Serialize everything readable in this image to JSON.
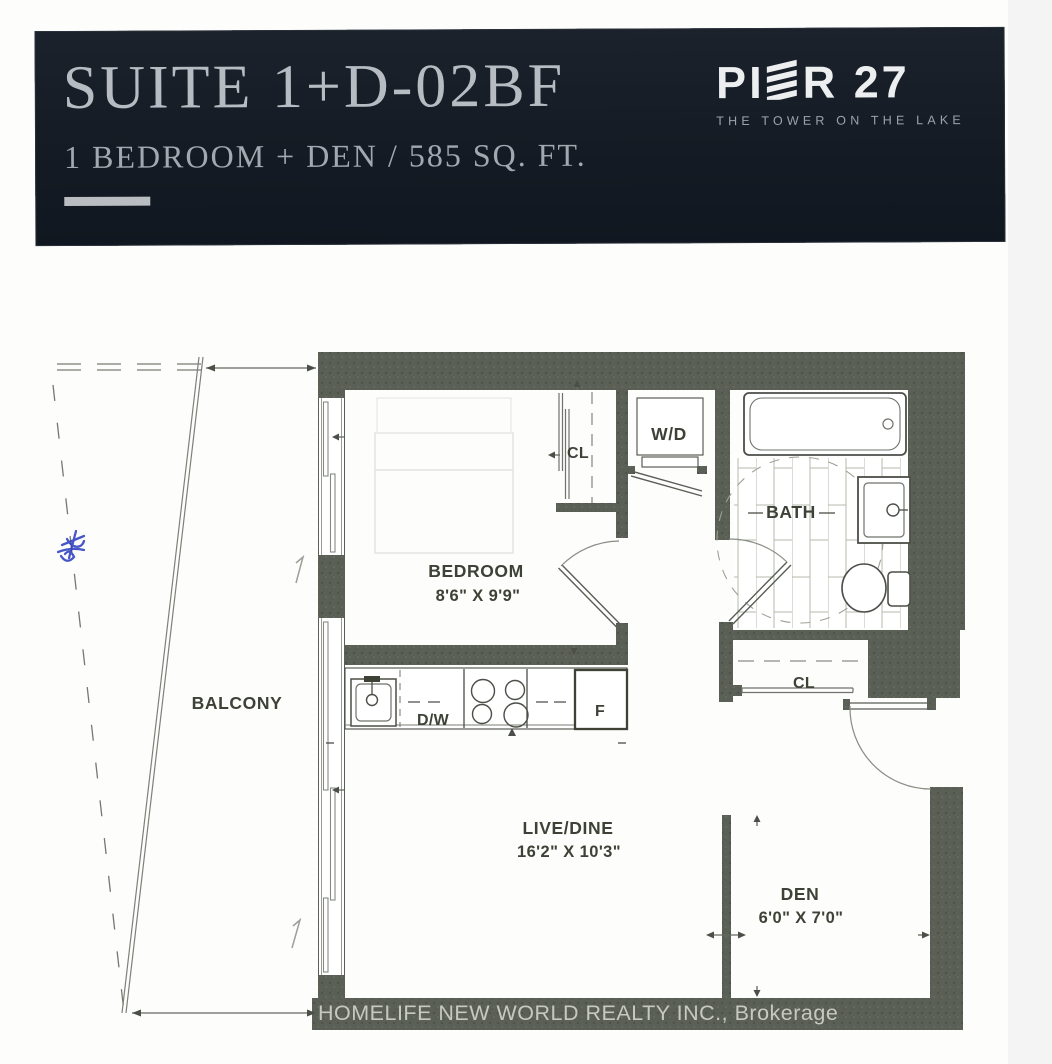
{
  "header": {
    "suite_title": "SUITE 1+D-02BF",
    "suite_subtitle": "1 BEDROOM + DEN / 585 SQ. FT.",
    "brand": {
      "prefix": "PI",
      "suffix": "R 27",
      "full_name": "PIER 27",
      "tagline": "THE TOWER ON THE LAKE"
    }
  },
  "floorplan": {
    "rooms": {
      "bedroom": {
        "name": "BEDROOM",
        "dims": "8'6\" X 9'9\""
      },
      "bath": {
        "name": "BATH"
      },
      "balcony": {
        "name": "BALCONY"
      },
      "live_dine": {
        "name": "LIVE/DINE",
        "dims": "16'2\" X 10'3\""
      },
      "den": {
        "name": "DEN",
        "dims": "6'0\" X 7'0\""
      }
    },
    "fixtures": {
      "washer_dryer": "W/D",
      "bedroom_closet": "CL",
      "entry_closet": "CL",
      "dishwasher": "D/W",
      "fridge": "F"
    },
    "watermark": "HOMELIFE NEW WORLD REALTY INC., Brokerage"
  },
  "colors": {
    "banner_bg": "#161d26",
    "banner_text": "#b6bcc2",
    "wall": "#5a6056",
    "line": "#4b4f47"
  }
}
